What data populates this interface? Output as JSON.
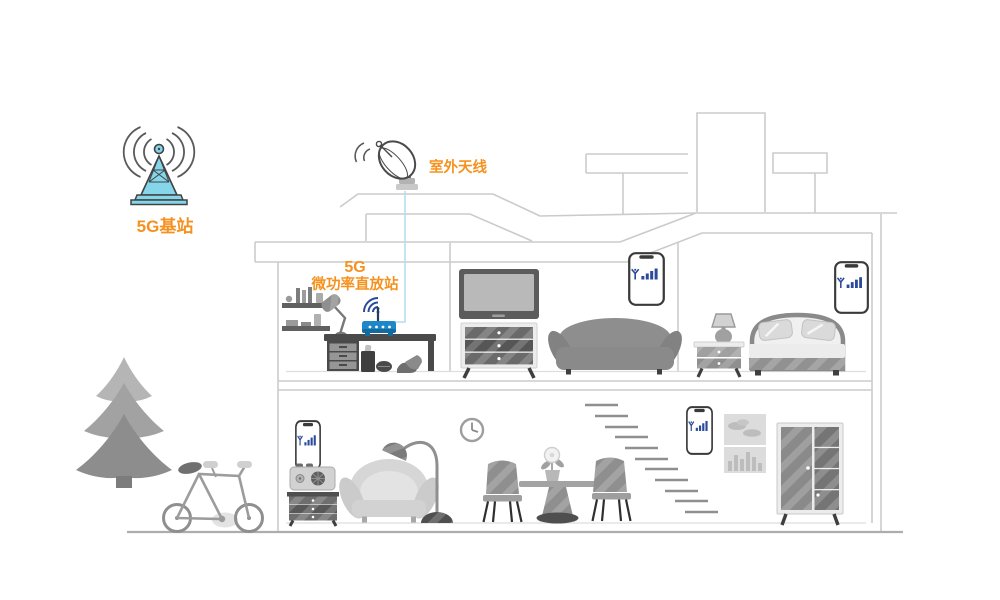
{
  "labels": {
    "base_station": "5G基站",
    "outdoor_antenna": "室外天线",
    "repeater_line1": "5G",
    "repeater_line2": "微功率直放站"
  },
  "colors": {
    "accent_orange": "#F5921F",
    "tower_cyan": "#85D6EA",
    "tower_outline": "#424242",
    "router_blue": "#1C87C9",
    "router_blue_dark": "#14699E",
    "signal_navy": "#2B4A9B",
    "connection_blue": "#B8DCEF",
    "outline_gray": "#CBCBCB",
    "ground_gray": "#ADADAD"
  },
  "icons": {
    "cell_tower_icon": "lattice mast with radio wave arcs",
    "satellite_dish_icon": "roof dish antenna with radio wave arcs",
    "wifi_icon": "wifi arcs above repeater",
    "router_icon": "blue 5G micro-power repeater box",
    "smartphone_signal_icon": "phone screen with antenna glyph and rising signal bars"
  },
  "scene": {
    "outdoor": [
      "5g-base-station",
      "pine-tree",
      "bicycle"
    ],
    "roof": [
      "outdoor-antenna",
      "chimney"
    ],
    "upper_floor": {
      "office": [
        "wall-shelves",
        "desk-lamp",
        "desk",
        "5g-repeater-router",
        "waste-bin",
        "ball",
        "shoes"
      ],
      "living_room": [
        "tv",
        "tv-cabinet",
        "sofa",
        "smartphone"
      ],
      "bedroom": [
        "nightstand",
        "table-lamp",
        "bed",
        "smartphone"
      ]
    },
    "ground_floor": [
      "smartphone",
      "radio",
      "drawer-cabinet",
      "armchair",
      "floor-lamp",
      "wall-clock",
      "dining-chair",
      "dining-table",
      "potted-plant",
      "dining-chair",
      "staircase",
      "smartphone",
      "wall-picture",
      "wardrobe"
    ],
    "smartphone_count": 4
  }
}
